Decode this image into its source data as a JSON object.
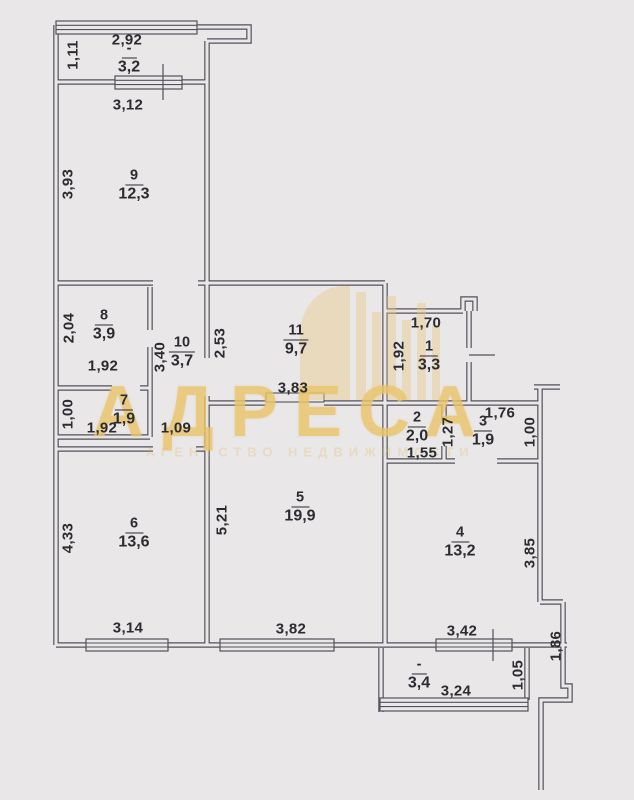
{
  "plan": {
    "watermark": {
      "title": "АДРЕСА",
      "subtitle": "АГЕНТСТВО НЕДВИЖИМОСТИ"
    },
    "rooms": {
      "balcony_top": {
        "number": "-",
        "area": "3,2"
      },
      "r9": {
        "number": "9",
        "area": "12,3"
      },
      "r8": {
        "number": "8",
        "area": "3,9"
      },
      "r10": {
        "number": "10",
        "area": "3,7"
      },
      "r7": {
        "number": "7",
        "area": "1,9"
      },
      "r11": {
        "number": "11",
        "area": "9,7"
      },
      "r1": {
        "number": "1",
        "area": "3,3"
      },
      "r2": {
        "number": "2",
        "area": "2,0"
      },
      "r3": {
        "number": "3",
        "area": "1,9"
      },
      "r5": {
        "number": "5",
        "area": "19,9"
      },
      "r6": {
        "number": "6",
        "area": "13,6"
      },
      "r4": {
        "number": "4",
        "area": "13,2"
      },
      "balcony_bottom": {
        "number": "-",
        "area": "3,4"
      }
    },
    "dims": {
      "balcony_top_width": "2,92",
      "balcony_top_depth": "1,11",
      "r9_width": "3,12",
      "r9_depth": "3,93",
      "r8_depth": "2,04",
      "r8_width": "1,92",
      "r10_depth": "3,40",
      "r10_pass": "1,09",
      "r7_depth": "1,00",
      "r7_width": "1,92",
      "r11_depth": "2,53",
      "r11_width": "3,83",
      "r1_width": "1,70",
      "r1_depth": "1,92",
      "r2_width": "1,55",
      "r2_depth": "1,27",
      "r3_width": "1,76",
      "r3_depth": "1,00",
      "r5_depth": "5,21",
      "r5_width": "3,82",
      "r6_depth": "4,33",
      "r6_width": "3,14",
      "r4_width": "3,42",
      "r4_depth": "3,85",
      "balcony_bottom_width": "3,24",
      "balcony_bottom_depth": "1,05",
      "right_side_depth": "1,86"
    }
  }
}
